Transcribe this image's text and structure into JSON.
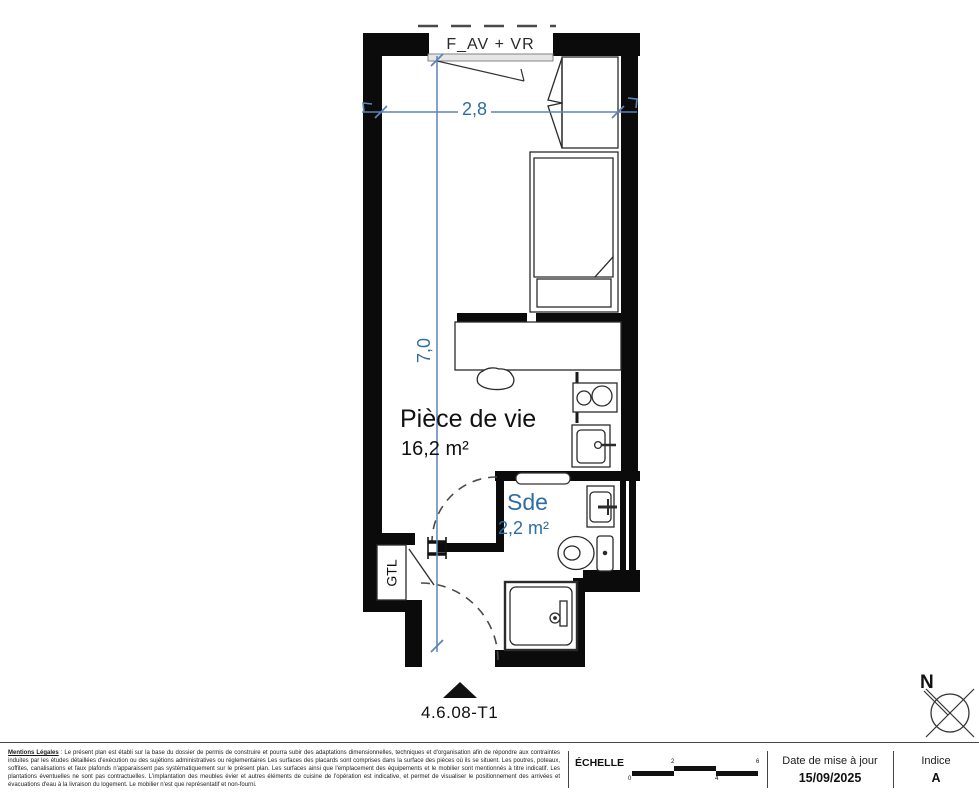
{
  "plan": {
    "window_label": "F_AV + VR",
    "dimensions": {
      "width": "2,8",
      "height": "7,0"
    },
    "rooms": {
      "living": {
        "name": "Pièce de vie",
        "area": "16,2 m²"
      },
      "bathroom": {
        "name": "Sde",
        "area": "2,2 m²"
      }
    },
    "gtl_label": "GTL",
    "unit_label": "4.6.08-T1"
  },
  "compass": {
    "north_label": "N"
  },
  "footer": {
    "legal_title": "Mentions Légales",
    "legal_text": " : Le présent plan est établi sur la base du dossier de permis de construire et pourra subir des adaptations dimensionnelles, techniques et d'organisation afin de répondre aux contraintes induites par les études détaillées d'exécution ou des sujétions administratives ou réglementaires Les surfaces des placards sont comprises dans la surface des pièces où ils se situent. Les poutres, poteaux, soffites, canalisations et faux plafonds n'apparaissent pas systématiquement sur le présent plan. Les surfaces ainsi que l'emplacement des équipements et le mobilier sont mentionnés à titre indicatif. Les plantations éventuelles ne sont pas contractuelles. L'implantation des meubles évier et autres éléments de cuisine de l'opération est indicative, et permet de visualiser le positionnement des arrivées et évacuations d'eau à la livraison du logement. Le mobilier n'est que représentatif et non-fourni.",
    "scale": {
      "label": "ÉCHELLE",
      "ticks": [
        "0",
        "2",
        "4",
        "6"
      ]
    },
    "date": {
      "label": "Date de mise à jour",
      "value": "15/09/2025"
    },
    "index": {
      "label": "Indice",
      "value": "A"
    }
  },
  "colors": {
    "wall": "#0b0b0b",
    "dimension_line": "#5b84b8",
    "dimension_text": "#2e6da4",
    "bathroom_text": "#2e6da4"
  }
}
